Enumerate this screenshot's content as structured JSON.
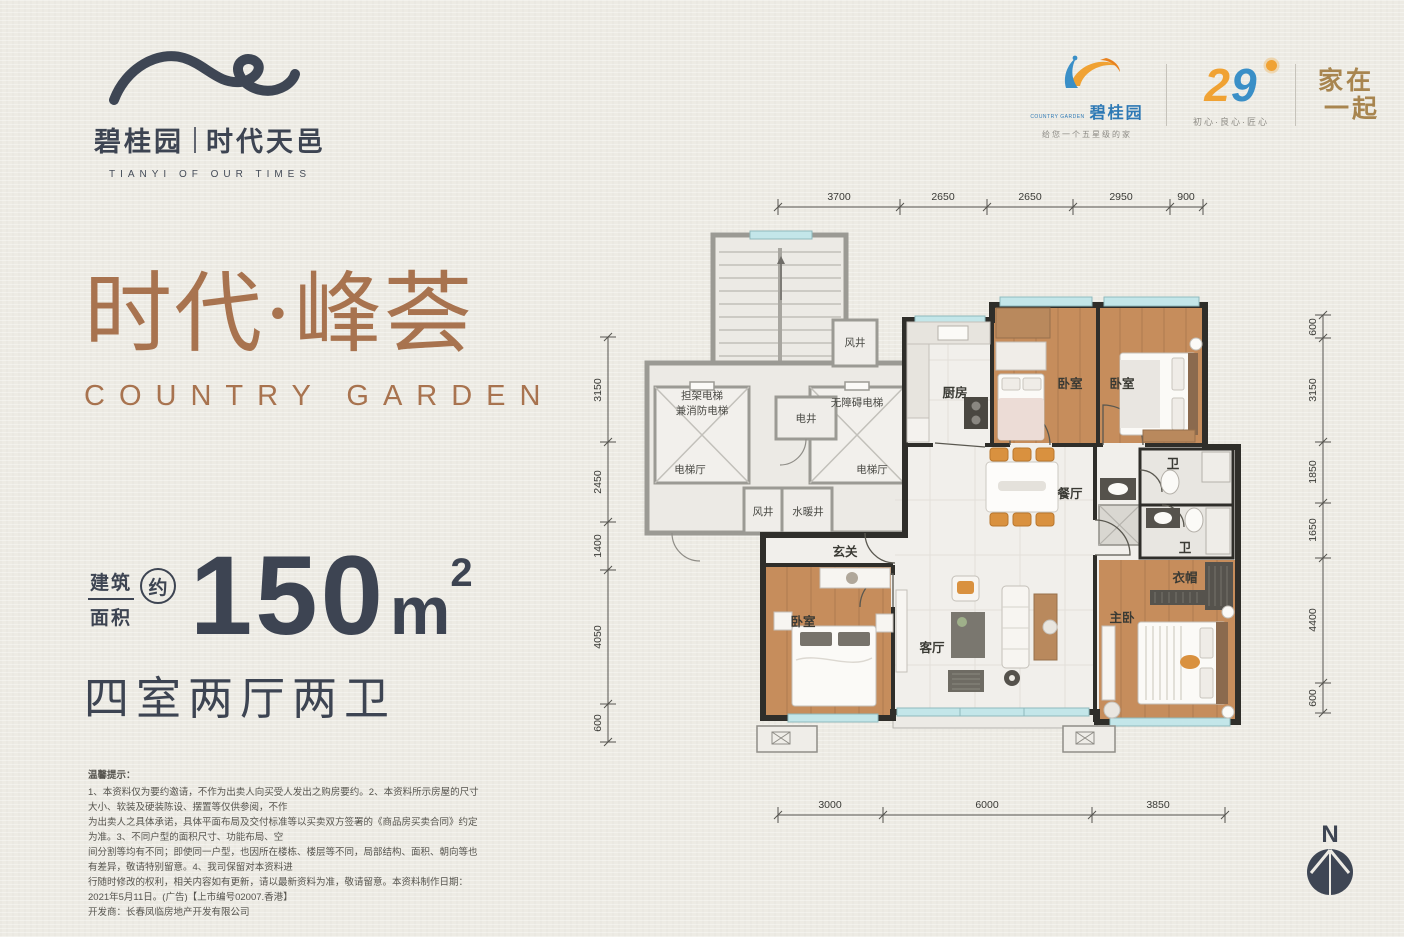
{
  "brand": {
    "name": "碧桂园",
    "project": "时代天邑",
    "tagline": "TIANYI OF OUR TIMES"
  },
  "corner": {
    "cg_sub": "COUNTRY GARDEN",
    "cg_name": "碧桂园",
    "cg_slogan": "给您一个五星级的家",
    "anniv_left": "2",
    "anniv_right": "9",
    "anniv_slogan": "初心·良心·匠心",
    "family_line1": "家在",
    "family_line2": "一起"
  },
  "hero": {
    "title": "时代·峰荟",
    "subtitle": "COUNTRY GARDEN",
    "area_prefix_top": "建筑",
    "area_prefix_bottom": "面积",
    "area_approx": "约",
    "area_value": "150",
    "area_unit": "m",
    "area_exponent": "2",
    "layout": "四室两厅两卫"
  },
  "disclaimer": {
    "title": "温馨提示：",
    "lines": [
      "1、本资料仅为要约邀请，不作为出卖人向买受人发出之购房要约。2、本资料所示房屋的尺寸大小、软装及硬装陈设、摆置等仅供参阅，不作",
      "为出卖人之具体承诺，具体平面布局及交付标准等以买卖双方签署的《商品房买卖合同》约定为准。3、不同户型的面积尺寸、功能布局、空",
      "间分割等均有不同；即使同一户型，也因所在楼栋、楼层等不同，局部结构、面积、朝向等也有差异，敬请特别留意。4、我司保留对本资料进",
      "行随时修改的权利，相关内容如有更新，请以最新资料为准，敬请留意。本资料制作日期：2021年5月11日。(广告)【上市编号02007.香港】",
      "开发商：长春凤临房地产开发有限公司"
    ]
  },
  "floorplan": {
    "rooms": {
      "kitchen": "厨房",
      "bedroom": "卧室",
      "master_bedroom": "主卧",
      "living_room": "客厅",
      "dining_room": "餐厅",
      "foyer": "玄关",
      "bathroom": "卫",
      "cloakroom": "衣帽",
      "elevator_hall": "电梯厅",
      "wind_shaft": "风井",
      "electric_shaft": "电井",
      "plumbing_shaft": "水暖井",
      "stretcher_elevator_line1": "担架电梯",
      "stretcher_elevator_line2": "兼消防电梯",
      "accessible_elevator": "无障碍电梯"
    },
    "dims_top": [
      "3700",
      "2650",
      "2650",
      "2950",
      "900"
    ],
    "dims_left": [
      "3150",
      "2450",
      "1400",
      "4050",
      "600"
    ],
    "dims_right": [
      "600",
      "3150",
      "1850",
      "1650",
      "4400",
      "600"
    ],
    "dims_bottom": [
      "3000",
      "6000",
      "3850"
    ],
    "compass": "N"
  },
  "colors": {
    "accent_brown": "#a8734f",
    "dark_navy": "#3d4452",
    "gold": "#a8854f",
    "brand_blue": "#2e79b5",
    "brand_orange": "#f0a233",
    "window_cyan": "#c3e6e9",
    "wood_floor": "#c68d5c"
  }
}
